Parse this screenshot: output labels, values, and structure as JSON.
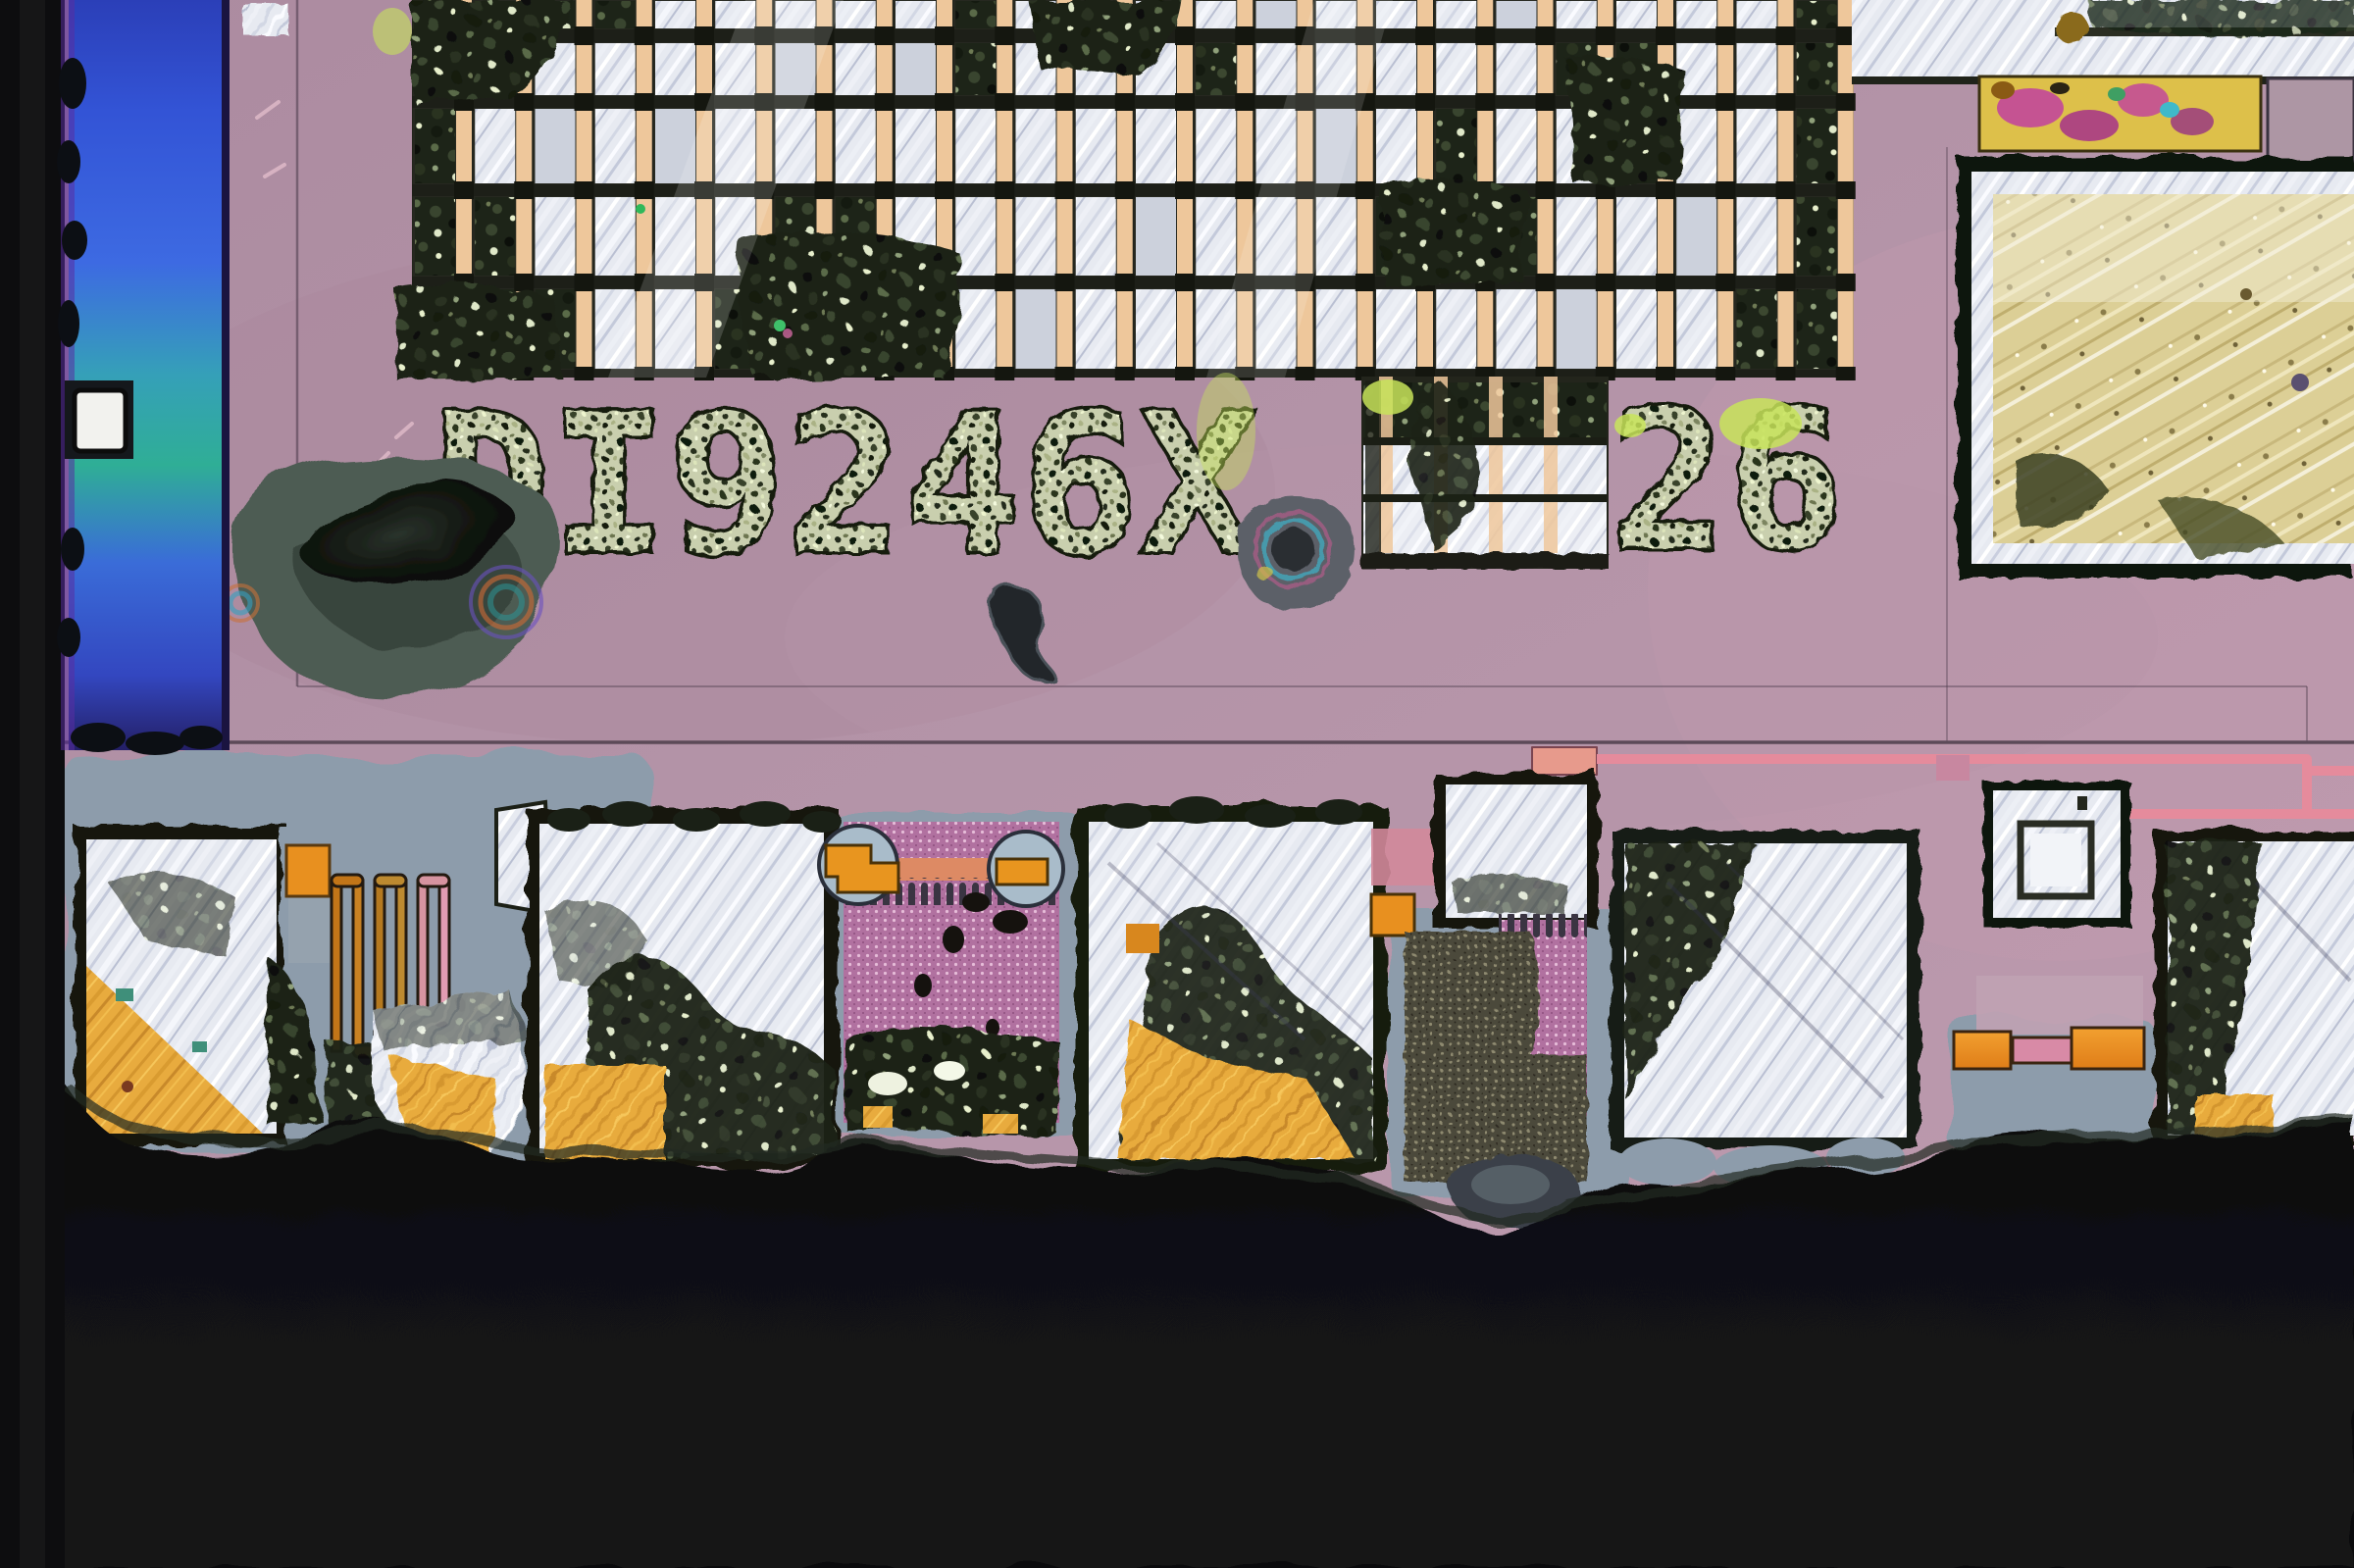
{
  "image_type": "Optical microscope photograph of an integrated-circuit die corner",
  "die_markings": {
    "line1": "DI9246X",
    "line2": "26"
  },
  "palette": {
    "die_surface_mauve": "#b08fa4",
    "passivation_stripe_blue": "#3a5cd8",
    "metal_silver": "#e7eaf1",
    "exposed_gold": "#e8ab3e",
    "resistor_orange": "#e8901f",
    "interconnect_trace_pink": "#e6899a",
    "test_array_pink": "#b171a0",
    "substrate_slate_gray": "#8fa0ad",
    "background_black": "#0a0a0c",
    "bus_via_peach": "#eec79b"
  },
  "regions": {
    "top": "metal bus grid of silver plates and peach via columns",
    "middle": "etched die identification marking",
    "right": "large probe pad with gold interior",
    "bottom": "row of torn bond pads, serpentine resistor and dotted test arrays",
    "left": "die edge with iridescent blue passivation stripe"
  }
}
